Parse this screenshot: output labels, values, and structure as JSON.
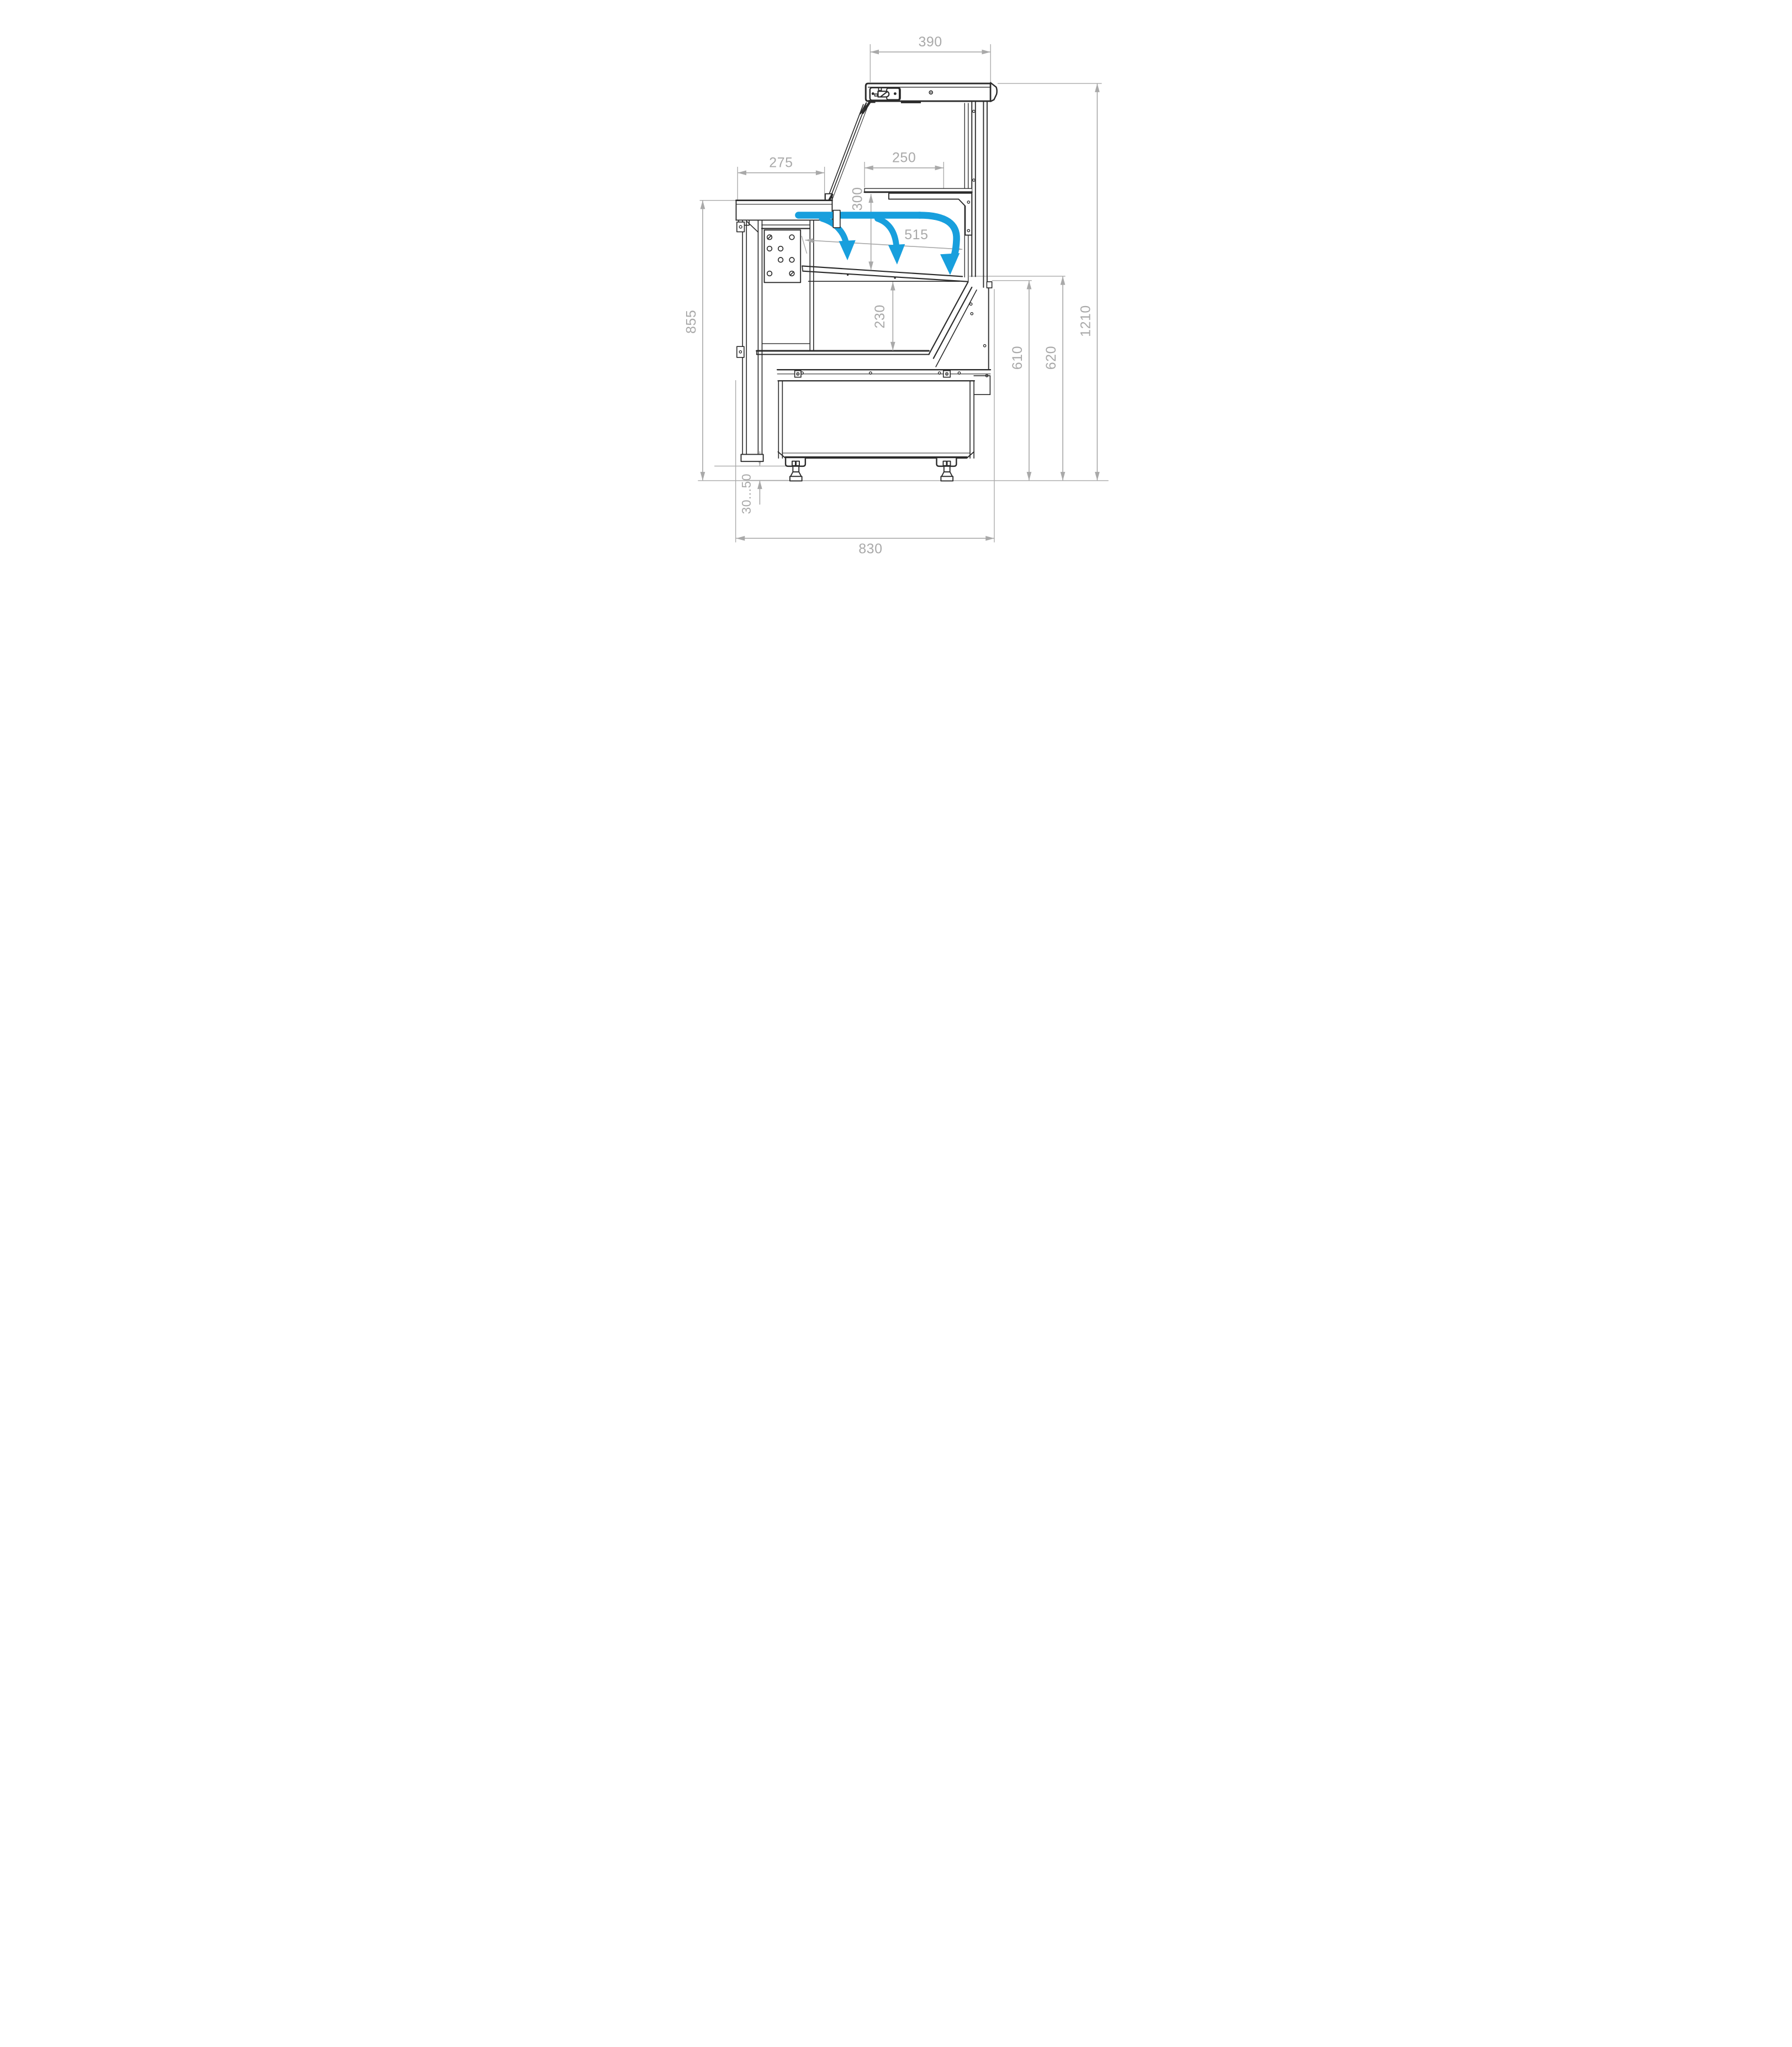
{
  "drawing": {
    "kind": "dimensioned-section-drawing",
    "units_shown": "none"
  },
  "colors": {
    "line": "#2b2b2b",
    "dimension": "#a9a9a9",
    "airflow": "#189fdd"
  },
  "dimensions": {
    "top_depth": "390",
    "shelf_depth": "250",
    "worktop_depth": "275",
    "shelf_to_deck_height": "300",
    "opening_depth": "515",
    "well_depth": "230",
    "worktop_height": "855",
    "deck_edge_height": "610",
    "front_edge_height": "620",
    "overall_height": "1210",
    "foot_adjust_range": "30...50",
    "base_depth": "830"
  }
}
